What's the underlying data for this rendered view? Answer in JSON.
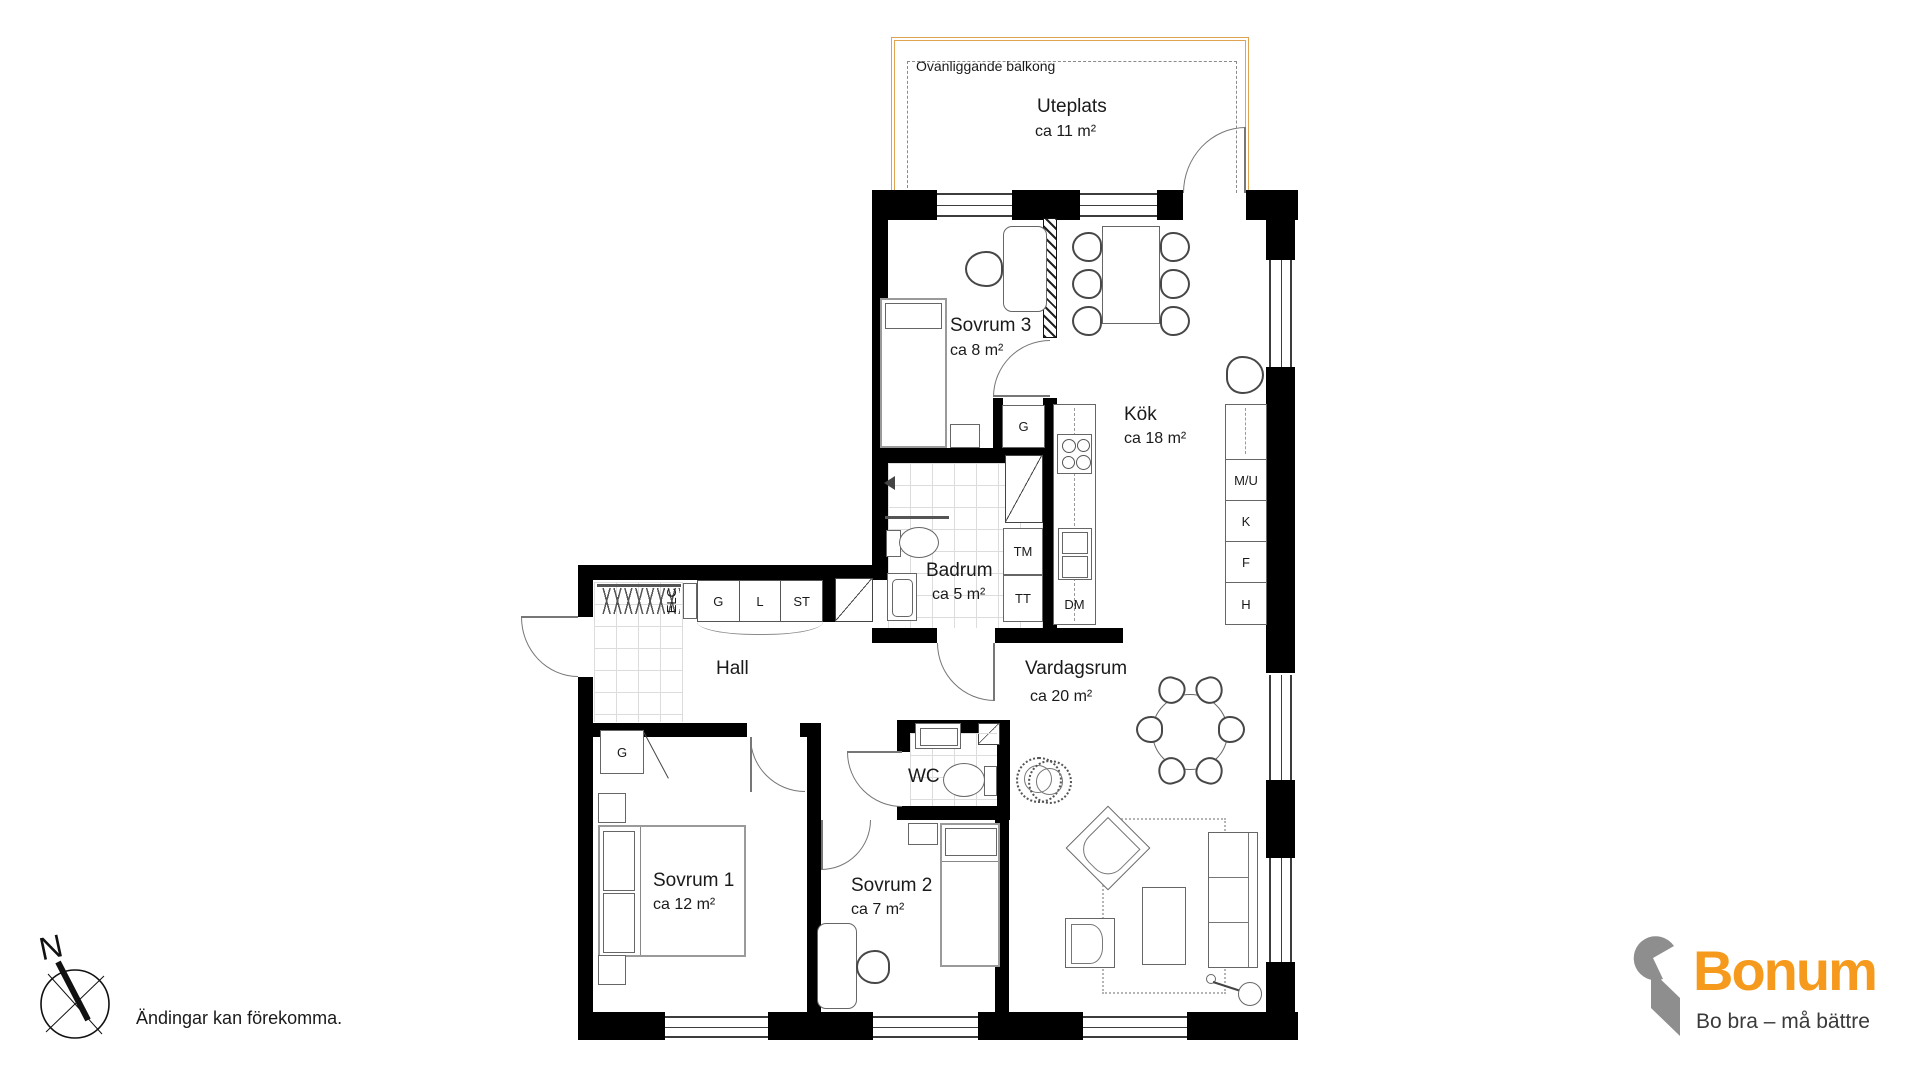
{
  "balcony": {
    "overhead_label": "Ovanliggande balkong",
    "name": "Uteplats",
    "area": "ca 11 m²"
  },
  "rooms": {
    "sovrum3": {
      "name": "Sovrum 3",
      "area": "ca 8 m²"
    },
    "kok": {
      "name": "Kök",
      "area": "ca 18 m²"
    },
    "badrum": {
      "name": "Badrum",
      "area": "ca 5 m²"
    },
    "hall": {
      "name": "Hall"
    },
    "vardagsrum": {
      "name": "Vardagsrum",
      "area": "ca 20 m²"
    },
    "wc": {
      "name": "WC"
    },
    "sovrum1": {
      "name": "Sovrum 1",
      "area": "ca 12 m²"
    },
    "sovrum2": {
      "name": "Sovrum 2",
      "area": "ca 7 m²"
    }
  },
  "closets": {
    "sovrum3_g": "G",
    "hall_g": "G",
    "hall_l": "L",
    "hall_st": "ST",
    "elc": "ELC",
    "sovrum1_g": "G"
  },
  "appliances": {
    "tm": "TM",
    "tt": "TT",
    "dm": "DM",
    "mu": "M/U",
    "k": "K",
    "f": "F",
    "h": "H"
  },
  "compass": {
    "north": "N"
  },
  "footer": {
    "disclaimer": "Ändingar kan förekomma."
  },
  "logo": {
    "brand": "Bonum",
    "tagline": "Bo bra – må bättre",
    "orange": "#F59A1C",
    "gray": "#8E8E8E"
  },
  "colors": {
    "wall": "#000000",
    "balcony_border": "#DFA351"
  }
}
